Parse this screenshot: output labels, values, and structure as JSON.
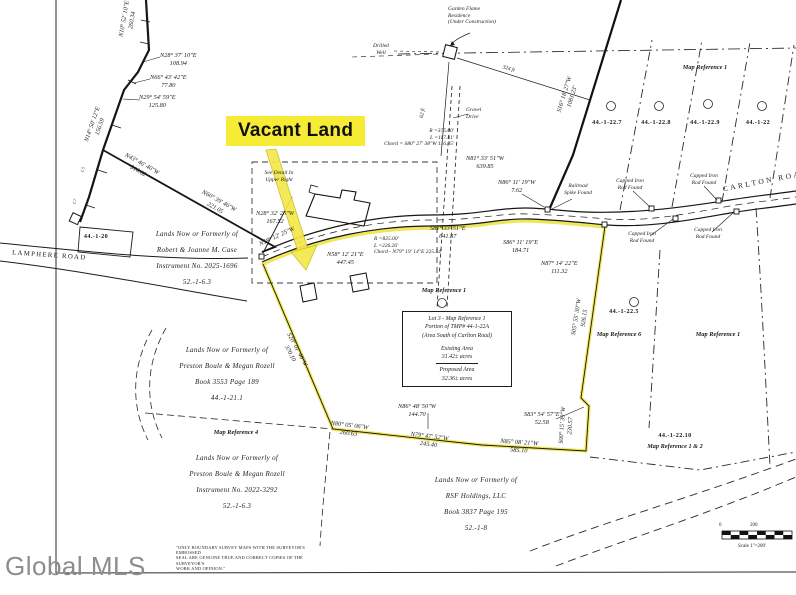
{
  "overlay": {
    "vacant_land": "Vacant Land",
    "watermark": "Global MLS"
  },
  "roads": {
    "carlton": "CARLTON ROAD",
    "lamphere": "LAMPHERE ROAD"
  },
  "parcel_blocks": {
    "case": {
      "l1": "Lands Now or Formerly of",
      "l2": "Robert & Joanne M. Case",
      "l3": "Instrument No. 2025-1696",
      "l4": "52.-1-6.3"
    },
    "boule_north": {
      "l1": "Lands Now or Formerly of",
      "l2": "Preston Boule & Megan Rozell",
      "l3": "Book 3553   Page 189",
      "l4": "44.-1-21.1"
    },
    "boule_south": {
      "l1": "Lands Now or Formerly of",
      "l2": "Preston Boule & Megan Rozell",
      "l3": "Instrument No. 2022-3292",
      "l4": "52.-1-6.3"
    },
    "rsf": {
      "l1": "Lands Now or Formerly of",
      "l2": "RSF Holdings, LLC",
      "l3": "Book 3837   Page 195",
      "l4": "52.-1-8"
    }
  },
  "lot3_box": {
    "l1": "Lot 3 - Map Reference 1",
    "l2": "Portion of TMP# 44-1-22A",
    "l3": "(Area South of Carlton Road)",
    "l4": "Existing Area",
    "l5": "31.42± acres",
    "l6": "Proposed Area",
    "l7": "32.36± acres"
  },
  "map_refs": {
    "center": "Map Reference 1",
    "top_right": "Map Reference 1",
    "ref4": "Map Reference 4",
    "ref6": "Map Reference 6",
    "right_mid": "Map Reference 1",
    "ref12": "Map Reference 1 & 2"
  },
  "lot_ids": {
    "tl20": "44.-1-20",
    "l227": "44.-1-22.7",
    "l228": "44.-1-22.8",
    "l229": "44.-1-22.9",
    "l22": "44.-1-22",
    "l225": "44.-1-22.5",
    "l2210": "44.-1-22.10"
  },
  "bearings": {
    "n2837": {
      "b": "N28° 37' 10\"E",
      "d": "108.94"
    },
    "n6643": {
      "b": "N66° 43' 42\"E",
      "d": "77.80"
    },
    "n2954": {
      "b": "N29° 54' 59\"E",
      "d": "125.80"
    },
    "n2832": {
      "b": "N28° 32' 25\"W",
      "d": "167.52"
    },
    "n5812": {
      "b": "N58° 12' 21\"E",
      "d": "447.45"
    },
    "s8133": {
      "b": "S81° 33' 51\"E",
      "d": "641.87"
    },
    "n8133": {
      "b": "N81° 33' 51\"W",
      "d": "639.85"
    },
    "s8611": {
      "b": "S86° 11' 19\"E",
      "d": "184.71"
    },
    "n8714": {
      "b": "N87° 14' 22\"E",
      "d": "111.32"
    },
    "n8611": {
      "b": "N86° 11' 19\"W",
      "d": "7.62"
    },
    "s8354": {
      "b": "S83° 54' 57\"E",
      "d": "52.58"
    },
    "n8648": {
      "b": "N86° 48' 50\"W",
      "d": "144.70"
    }
  },
  "rotated": {
    "top": {
      "b": "N10° 52' 10\"E",
      "d": "260.34"
    },
    "left": {
      "b": "N14° 50' 12\"E",
      "d": "156.59"
    },
    "diag1": {
      "b": "N43° 46' 40\"W",
      "d": "516.82"
    },
    "diag2": {
      "b": "N60° 39' 46\"W",
      "d": "221.05"
    },
    "steep": {
      "b": "S16° 18' 27\"W",
      "d": "1081.23'"
    },
    "road_inline": "N58° 12' 25\"W",
    "west": {
      "b": "S20° 01' 46\"W",
      "d": "370.10"
    },
    "east": {
      "b": "S05° 55' 30\"W",
      "d": "926.15"
    },
    "vert": {
      "b": "S00° 15' 39\"W",
      "d": "230.57"
    },
    "bot1": {
      "b": "N80° 05' 06\"W",
      "d": "260.63"
    },
    "bot2": {
      "b": "N79° 47' 52\"W",
      "d": "245.40"
    },
    "bot3": {
      "b": "N85° 08' 21\"W",
      "d": "585.10"
    },
    "tick1": "1.5",
    "tick2": "1.7"
  },
  "curves": {
    "c1": {
      "r": "R =375.00'",
      "l": "L =117.41'",
      "chord": "Chord = S80° 27' 38\"W 116.85'"
    },
    "c2": {
      "r": "R =825.00'",
      "l": "L =226.26'",
      "chord": "Chord - N79° 19' 14\"E 225.54'"
    }
  },
  "features": {
    "garden1": "Garden Flame",
    "garden2": "Residence",
    "garden3": "(Under Construction)",
    "well1": "Drilled",
    "well2": "Well",
    "gravel1": "Gravel",
    "gravel2": "Drive",
    "rr1": "Railroad",
    "rr2": "Spike Found",
    "cap1": "Capped Iron",
    "cap2": "Rod Found",
    "detail1": "See Detail In",
    "detail2": "Upper Right",
    "d324": "324 ft",
    "d62": "62 ft"
  },
  "scale": {
    "zero": "0",
    "two_hundred": "200",
    "label": "Scale 1\"=200'"
  },
  "disclaimer": {
    "l1": "\"ONLY BOUNDARY SURVEY MAPS WITH THE SURVEYOR'S EMBOSSED",
    "l2": "SEAL ARE GENUINE TRUE AND CORRECT COPIES OF THE SURVEYOR'S",
    "l3": "WORK AND OPINION.\""
  },
  "colors": {
    "highlight_label": "#f7ec35",
    "boundary_highlight": "#ece23c",
    "ink": "#1c1c1c",
    "watermark_gray": "#8d8d8d"
  }
}
